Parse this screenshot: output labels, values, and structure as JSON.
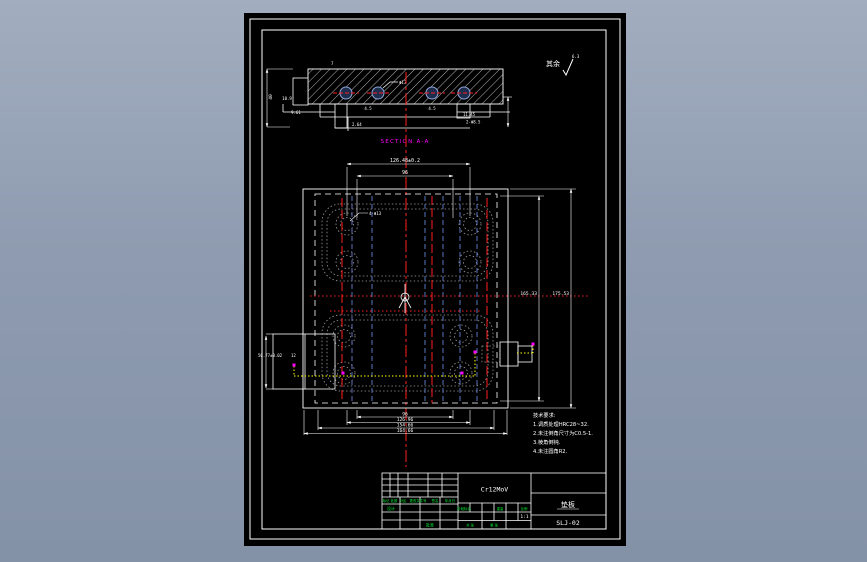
{
  "annotations": {
    "surface_prefix": "其余",
    "surface_value": "6.3",
    "section_label": "SECTION A-A"
  },
  "section_view": {
    "dims": {
      "d40": "40",
      "d109": "10.9",
      "d961": "9.61",
      "d264": "2.64",
      "d45a": "4.5",
      "d45b": "4.5",
      "d7": "7",
      "dphi13": "Φ13",
      "d1145": "11.45",
      "d2phi85": "2-Φ8.5"
    }
  },
  "plan_view": {
    "dims": {
      "top1": "126.48±0.2",
      "top2": "96",
      "right1": "165.33",
      "right2": "175.53",
      "bottom1": "96",
      "bottom2": "126.96",
      "bottom3": "154.66",
      "bottom4": "164.66",
      "left1": "50.77±0.02",
      "left2": "12",
      "leader": "4-Φ13"
    }
  },
  "notes": {
    "title": "技术要求:",
    "items": [
      "1.调质处理HRC28~32.",
      "2.未注倒角尺寸为C0.5-1.",
      "3.棱角倒钝.",
      "4.未注圆角R2."
    ]
  },
  "title_block": {
    "material": "Cr12MoV",
    "part_name": "垫板",
    "drawing_no": "SLJ-02",
    "rev_headers": [
      "标记",
      "处数",
      "分区",
      "更改文件号",
      "签名",
      "年月日"
    ],
    "row_design": "设计",
    "row_approve": "批准",
    "stage_label": "阶段标记",
    "weight_label": "重量",
    "scale_label": "比例",
    "scale_value": "1:1",
    "sheet_left": "共 张",
    "sheet_right": "第 张"
  },
  "colors": {
    "line": "#ffffff",
    "center_red": "#ff2020",
    "aux_blue": "#5a78bd",
    "ghost_gray": "#9a9a9a",
    "path_yellow": "#ffff00",
    "point_magenta": "#ff00ff",
    "table_green": "#00ee33"
  }
}
